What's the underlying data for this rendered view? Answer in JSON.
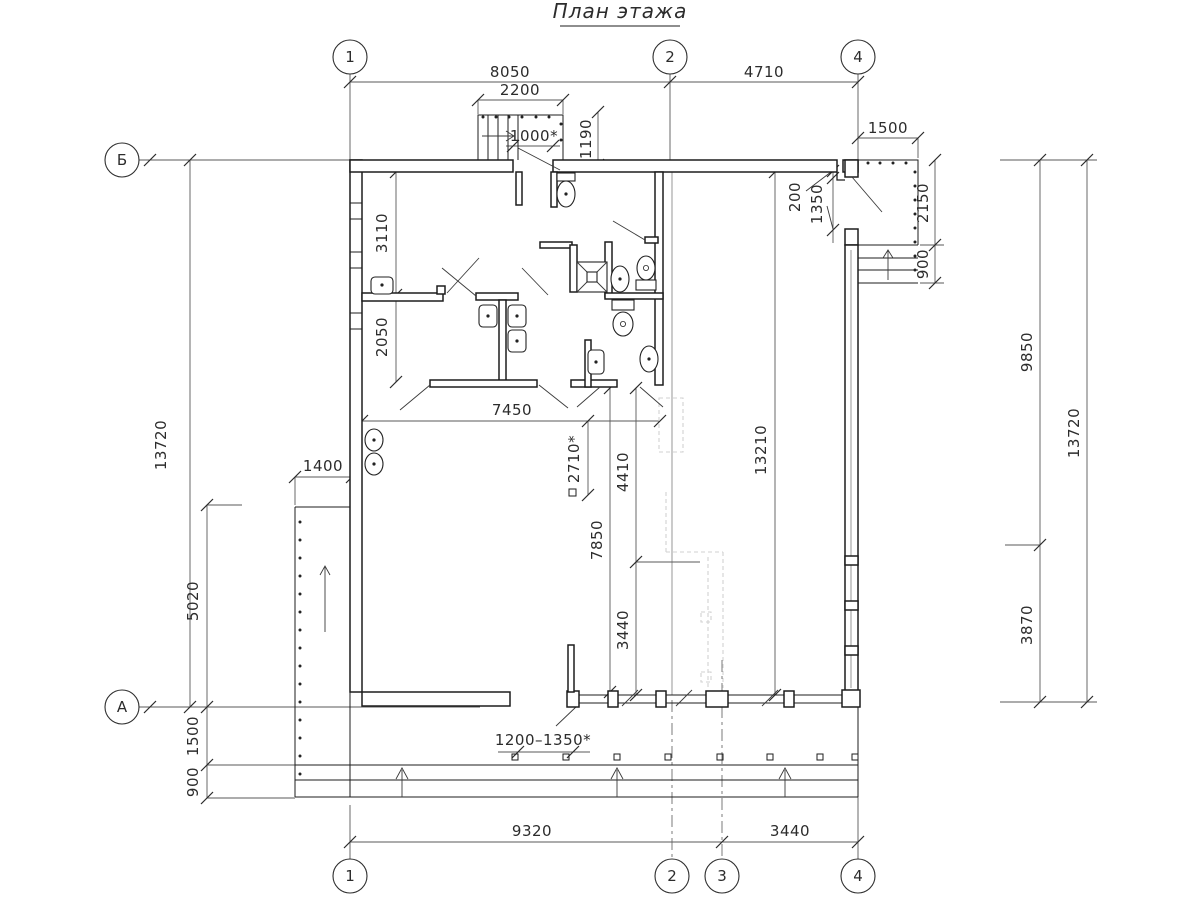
{
  "title": "План этажа",
  "axes": {
    "top": [
      "1",
      "2",
      "4"
    ],
    "left": [
      "Б",
      "А"
    ],
    "bottom": [
      "1",
      "2",
      "3",
      "4"
    ]
  },
  "dims": {
    "top_8050": "8050",
    "top_4710": "4710",
    "porch_2200": "2200",
    "entry_1000": "1000*",
    "porch_1190": "1190",
    "rporch_1500": "1500",
    "corner_200": "200",
    "corner_1350": "1350",
    "rporch_2150": "2150",
    "rporch_900": "900",
    "right_9850": "9850",
    "right_3870": "3870",
    "right_13720": "13720",
    "left_13720": "13720",
    "left_5020": "5020",
    "left_1500": "1500",
    "left_900": "900",
    "ramp_1400": "1400",
    "room_3110": "3110",
    "room_2050": "2050",
    "hall_7450": "7450",
    "hall_2710": "2710*",
    "hall_7850": "7850",
    "hall_4410": "4410",
    "hall_3440": "3440",
    "hall_13210": "13210",
    "bottom_9320": "9320",
    "bottom_3440": "3440",
    "terrace_1200_1350": "1200–1350*"
  }
}
